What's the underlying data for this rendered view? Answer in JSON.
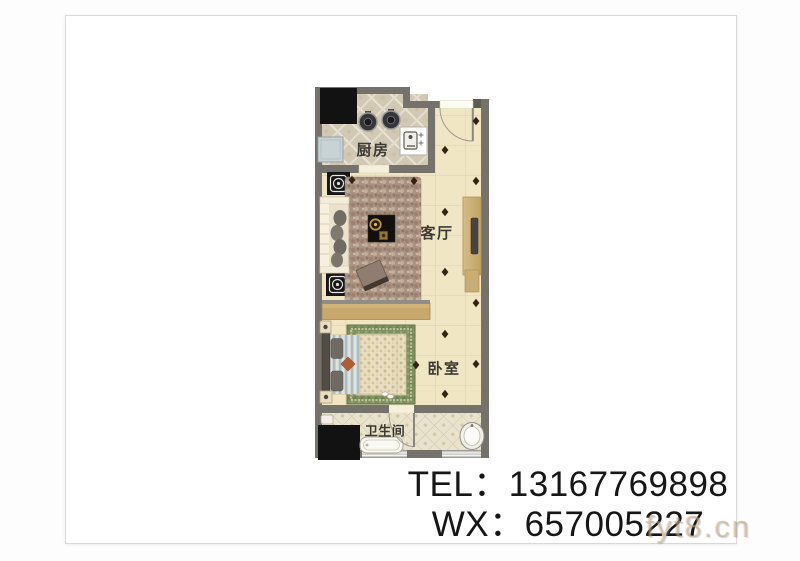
{
  "plan": {
    "rooms": {
      "kitchen": "厨房",
      "living": "客厅",
      "bedroom": "卧室",
      "bathroom": "卫生间"
    }
  },
  "contact": {
    "tel": "TEL：13167769898",
    "wx": "WX：657005227"
  },
  "watermark": "fyt8.cn",
  "colors": {
    "wall": "#74726a",
    "living_floor": "#f0e6c4",
    "kitchen_floor": "#d2c9b4",
    "bath_floor": "#e9e3cd",
    "divider": "#c7a76c",
    "text": "#161616"
  }
}
